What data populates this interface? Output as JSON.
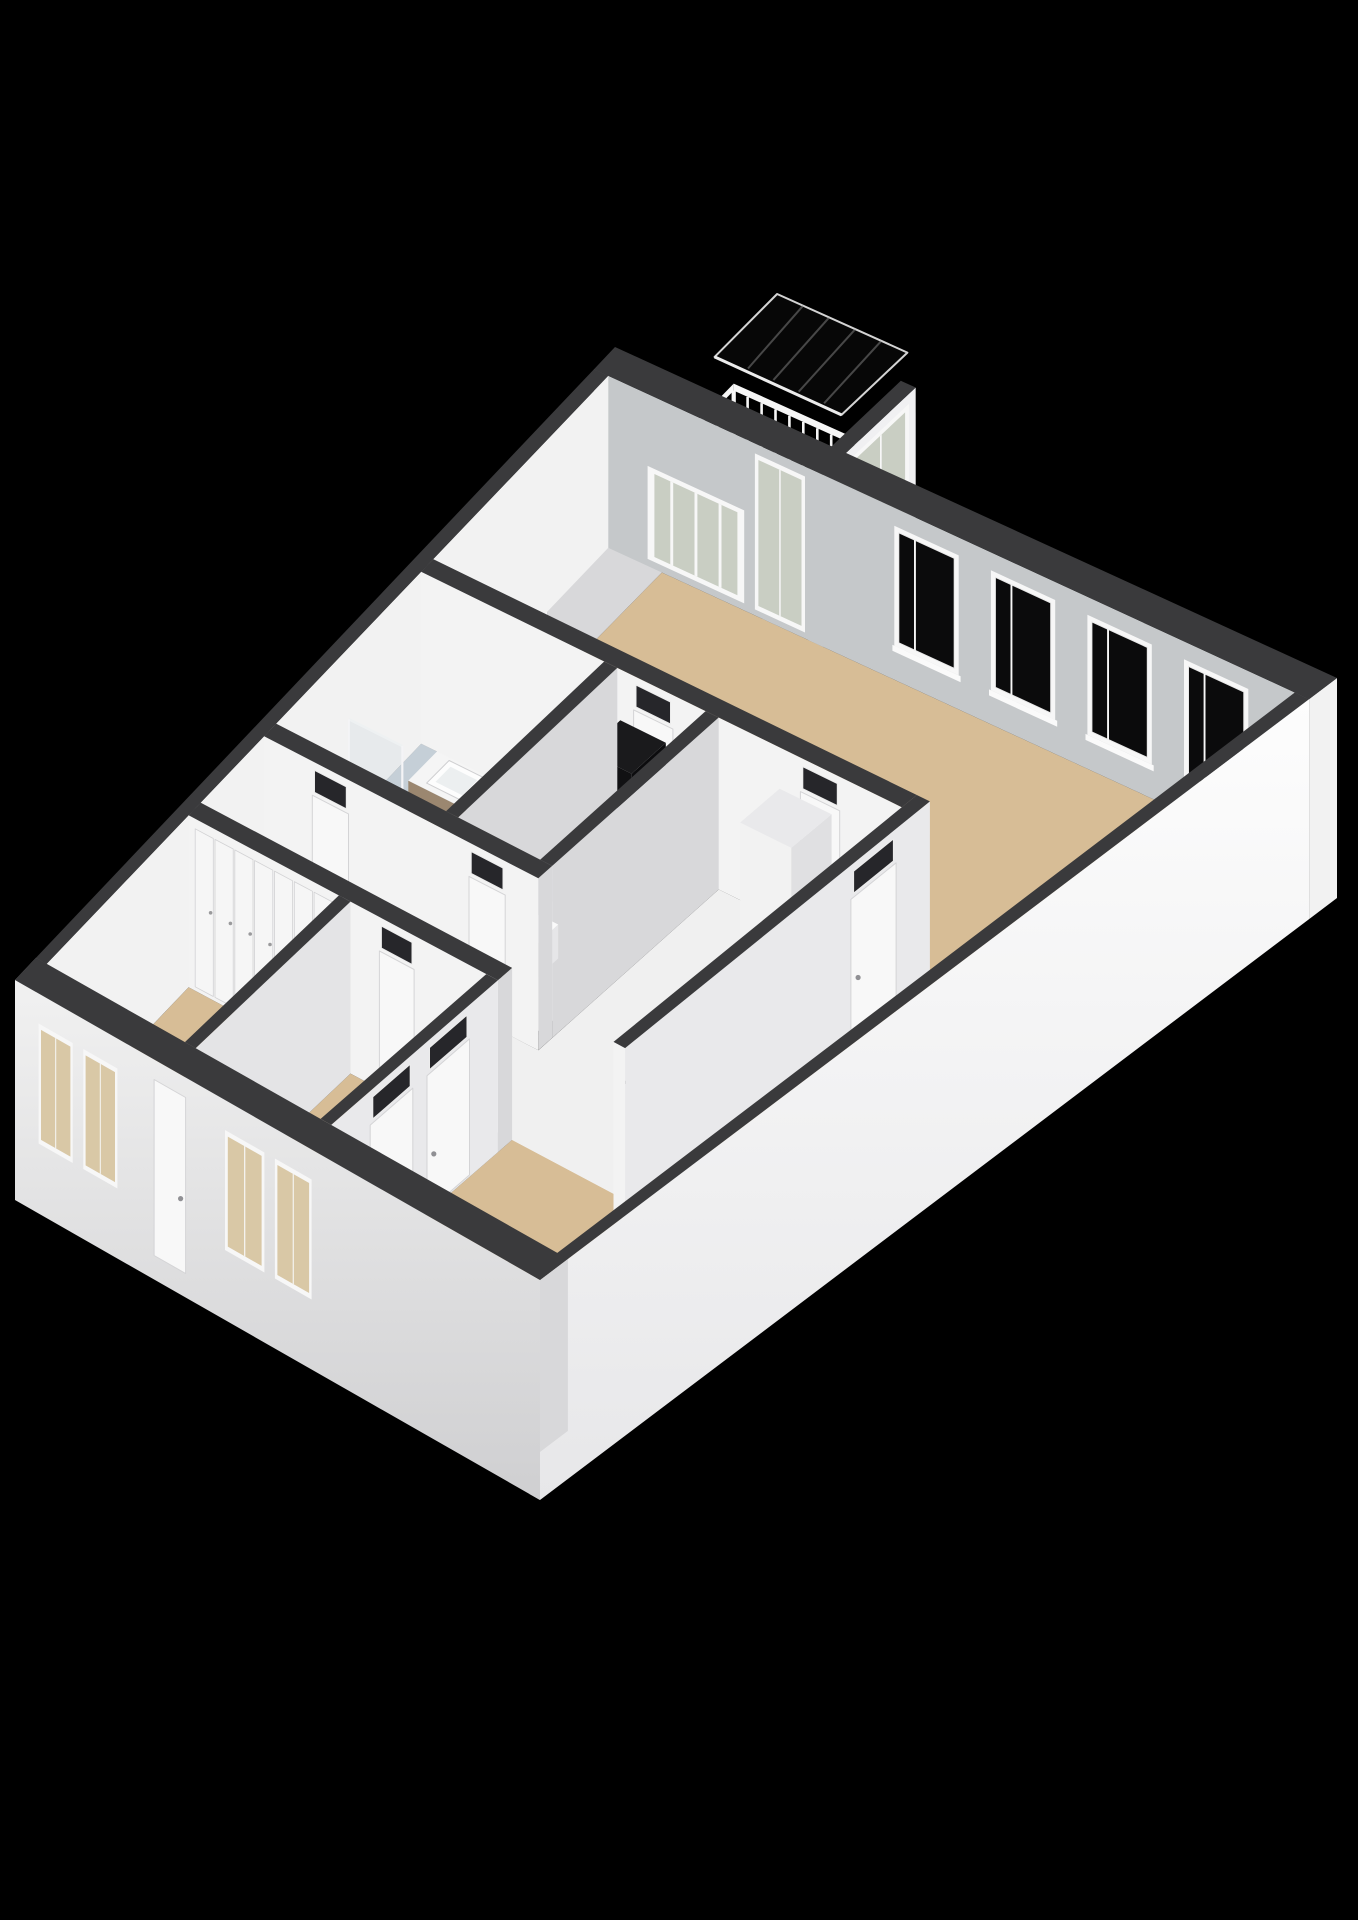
{
  "scene": {
    "width": 1358,
    "height": 1920,
    "background": "#000000",
    "description": "3D isometric floor plan of an apartment on black background"
  },
  "projection": {
    "A": [
      615,
      347
    ],
    "B": [
      1337,
      678
    ],
    "D": [
      15,
      980
    ],
    "C": [
      540,
      1280
    ],
    "wall_height": 172,
    "exterior_drop": 220,
    "rail_top": 78,
    "rail_thickness": 7
  },
  "palette": {
    "wallTop": "#3a3a3c",
    "faceS": "#f3f3f3",
    "faceE": "#d8d8da",
    "neInner": "#c5c8ca",
    "extCapW": "#98989a",
    "floorWood": "#d7bd96",
    "floorWhite": "#f0f0f0",
    "floorBath": "#b7c3cd",
    "floorShower": "#ced6db",
    "floorBalcony": "#c6c6ba",
    "glassDark": "#0b0b0c",
    "glassPale": "#c9cec3",
    "glassWarm": "#d9c8a6",
    "frame": "#f7f7f7",
    "frameStroke": "#d4d4d6",
    "counterTop": "#232323",
    "cabinet": "#ededed",
    "cabinetSide": "#dcdcde",
    "steel": "#c6cbce",
    "steelDark": "#73797c",
    "burnerOuter": "#c3251d",
    "burnerInner": "#3a0f0c",
    "burnerDot": "#d2342a",
    "wood": "#9b8770",
    "woodSide": "#84715a",
    "nicheTop": "#1a1a1c",
    "nicheS": "#111113",
    "nicheE": "#0c0c0e",
    "red": "#d22b22",
    "transom": "#26262a",
    "handle": "#909094",
    "railWhite": "#f6f6f6",
    "glassShower": "rgba(216,224,228,0.42)",
    "glassShowerEdge": "#eef1f2",
    "canopyFill": "rgba(8,8,8,0.85)",
    "canopyEdge": "#d4d4d4",
    "canopyStreak": "rgba(150,150,150,0.45)"
  },
  "floors": [
    {
      "name": "balcony-floor",
      "rect": [
        0.075,
        -0.105,
        0.3,
        0.0
      ],
      "color": "floorBalcony"
    },
    {
      "name": "living-room-floor",
      "poly": [
        [
          0.095,
          0.035
        ],
        [
          0.98,
          0.035
        ],
        [
          0.98,
          0.965
        ],
        [
          0.555,
          0.965
        ],
        [
          0.555,
          0.325
        ],
        [
          0.095,
          0.325
        ]
      ],
      "color": "floorWood"
    },
    {
      "name": "storage-room-floor",
      "rect": [
        0.02,
        0.035,
        0.075,
        0.325
      ],
      "color": "floorWhite"
    },
    {
      "name": "bathroom-floor",
      "rect": [
        0.02,
        0.345,
        0.3,
        0.585
      ],
      "color": "floorBath"
    },
    {
      "name": "shower-floor",
      "rect": [
        0.03,
        0.375,
        0.115,
        0.475
      ],
      "color": "floorShower"
    },
    {
      "name": "utility-room-floor",
      "rect": [
        0.32,
        0.345,
        0.455,
        0.585
      ],
      "color": "floorWhite"
    },
    {
      "name": "kitchen-floor",
      "rect": [
        0.475,
        0.345,
        0.755,
        0.71
      ],
      "color": "floorWhite"
    },
    {
      "name": "hallway-floor",
      "rect": [
        0.02,
        0.605,
        0.755,
        0.71
      ],
      "color": "floorWhite"
    },
    {
      "name": "bedroom-left-floor",
      "rect": [
        0.02,
        0.73,
        0.28,
        0.965
      ],
      "color": "floorWood"
    },
    {
      "name": "bedroom-bottom-floor",
      "rect": [
        0.3,
        0.73,
        0.535,
        0.965
      ],
      "color": "floorWood"
    }
  ],
  "railings": [
    {
      "name": "balcony-railing-back",
      "from": [
        0.075,
        -0.105
      ],
      "to": [
        0.3,
        -0.105
      ],
      "posts": 13
    },
    {
      "name": "balcony-railing-side",
      "from": [
        0.075,
        0.0
      ],
      "to": [
        0.075,
        -0.105
      ],
      "posts": 5
    }
  ],
  "walls": [
    {
      "name": "ne-exterior-wall",
      "rect": [
        0.0,
        0.0,
        1.0,
        0.035
      ],
      "faces": {
        "s": "neInner",
        "e": "#f2f2f2",
        "eDrop": 220
      },
      "panels": [
        {
          "name": "balcony-picture-window",
          "face": "s",
          "a": 0.075,
          "b": 0.21,
          "kind": "winpale",
          "t": [
            72,
            165
          ],
          "mullions": [
            0.25,
            0.5,
            0.75
          ]
        },
        {
          "name": "balcony-glazed-door",
          "face": "s",
          "a": 0.225,
          "b": 0.295,
          "kind": "winpale",
          "t": [
            10,
            166
          ],
          "mullions": [
            0.5
          ]
        },
        {
          "name": "living-window-1",
          "face": "s",
          "a": 0.42,
          "b": 0.51,
          "kind": "dark",
          "t": [
            18,
            138
          ],
          "sill": true,
          "mullions": [
            0.32
          ]
        },
        {
          "name": "living-window-2",
          "face": "s",
          "a": 0.555,
          "b": 0.645,
          "kind": "dark",
          "t": [
            18,
            138
          ],
          "sill": true,
          "mullions": [
            0.32
          ]
        },
        {
          "name": "living-window-3",
          "face": "s",
          "a": 0.69,
          "b": 0.78,
          "kind": "dark",
          "t": [
            18,
            138
          ],
          "sill": true,
          "mullions": [
            0.32
          ]
        },
        {
          "name": "living-window-4",
          "face": "s",
          "a": 0.825,
          "b": 0.915,
          "kind": "dark",
          "t": [
            18,
            138
          ],
          "sill": true,
          "mullions": [
            0.32
          ]
        }
      ]
    },
    {
      "name": "balcony-side-wall",
      "rect": [
        0.3,
        -0.105,
        0.32,
        0.035
      ],
      "faces": {
        "e": "#f0f0f2"
      },
      "panels": [
        {
          "name": "balcony-side-glazed-door",
          "face": "e",
          "a": -0.095,
          "b": -0.01,
          "kind": "winpale",
          "t": [
            10,
            166
          ],
          "mullions": [
            0.5
          ]
        }
      ]
    },
    {
      "name": "se-exterior-wall",
      "rect": [
        0.98,
        0.035,
        1.0,
        1.0
      ],
      "faces": {
        "e": "gradSE",
        "eDrop": 220,
        "s": "#ededed",
        "sDrop": 220
      }
    },
    {
      "name": "nw-exterior-wall",
      "rect": [
        0.0,
        0.035,
        0.02,
        0.965
      ],
      "faces": {
        "e": "#f2f2f2"
      }
    },
    {
      "name": "storage-wall",
      "rect": [
        0.075,
        0.035,
        0.095,
        0.325
      ],
      "panels": [
        {
          "name": "storage-door",
          "face": "e",
          "a": 0.22,
          "b": 0.29,
          "kind": "door",
          "t": [
            34,
            170
          ],
          "transom": false
        }
      ]
    },
    {
      "name": "living-block-wall",
      "rect": [
        0.02,
        0.325,
        0.755,
        0.345
      ],
      "panels": [
        {
          "name": "corridor-door",
          "face": "s",
          "a": 0.345,
          "b": 0.405,
          "kind": "door",
          "t": [
            34,
            170
          ],
          "transom": true
        },
        {
          "name": "kitchen-top-door",
          "face": "s",
          "a": 0.6,
          "b": 0.66,
          "kind": "door",
          "t": [
            34,
            170
          ],
          "transom": true
        }
      ]
    },
    {
      "name": "bathroom-right-wall",
      "rect": [
        0.3,
        0.345,
        0.32,
        0.585
      ]
    },
    {
      "name": "utility-right-wall",
      "rect": [
        0.455,
        0.345,
        0.475,
        0.585
      ]
    },
    {
      "name": "hall-top-wall",
      "rect": [
        0.02,
        0.585,
        0.475,
        0.605
      ],
      "panels": [
        {
          "name": "bathroom-door",
          "face": "s",
          "a": 0.1,
          "b": 0.16,
          "kind": "door",
          "t": [
            34,
            170
          ],
          "transom": true
        },
        {
          "name": "utility-door",
          "face": "s",
          "a": 0.36,
          "b": 0.42,
          "kind": "door",
          "t": [
            34,
            170
          ],
          "transom": true
        }
      ]
    },
    {
      "name": "kitchen-right-wall",
      "rect": [
        0.755,
        0.325,
        0.775,
        0.73
      ],
      "faces": {
        "e": "#e9e9eb"
      },
      "panels": [
        {
          "name": "kitchen-living-door",
          "face": "e",
          "a": 0.37,
          "b": 0.43,
          "kind": "door",
          "t": [
            34,
            170
          ],
          "transom": true
        }
      ]
    },
    {
      "name": "bedrooms-top-wall",
      "rect": [
        0.02,
        0.71,
        0.555,
        0.73
      ],
      "panels": [
        {
          "name": "closet-row",
          "face": "s",
          "a": 0.03,
          "b": 0.27,
          "kind": "closets",
          "count": 7,
          "t": [
            10,
            168
          ]
        },
        {
          "name": "bedroom-bottom-door",
          "face": "s",
          "a": 0.35,
          "b": 0.41,
          "kind": "door",
          "t": [
            34,
            170
          ],
          "transom": true
        }
      ]
    },
    {
      "name": "bedroom-bottom-right-wall",
      "rect": [
        0.535,
        0.73,
        0.555,
        0.965
      ],
      "faces": {
        "e": "#e9e9eb"
      },
      "panels": [
        {
          "name": "living-hall-door-1",
          "face": "e",
          "a": 0.77,
          "b": 0.83,
          "kind": "door",
          "t": [
            34,
            170
          ],
          "transom": true
        },
        {
          "name": "living-hall-door-2",
          "face": "e",
          "a": 0.85,
          "b": 0.91,
          "kind": "door",
          "t": [
            34,
            170
          ],
          "transom": true
        }
      ]
    },
    {
      "name": "bedroom-divider-wall",
      "rect": [
        0.28,
        0.73,
        0.3,
        0.965
      ],
      "faces": {
        "e": "#e4e4e6"
      }
    },
    {
      "name": "sw-exterior-wall",
      "rect": [
        0.0,
        0.965,
        1.0,
        1.0
      ],
      "faces": {
        "s": "gradSW",
        "sDrop": 220,
        "w": "extCapW",
        "wDrop": 220
      },
      "panels": [
        {
          "name": "bedroom-left-window-1",
          "face": "s",
          "a": 0.045,
          "b": 0.11,
          "kind": "warm",
          "t": [
            30,
            150
          ],
          "mullions": [
            0.5
          ]
        },
        {
          "name": "bedroom-left-window-2",
          "face": "s",
          "a": 0.13,
          "b": 0.195,
          "kind": "warm",
          "t": [
            30,
            150
          ],
          "mullions": [
            0.5
          ]
        },
        {
          "name": "entrance-door",
          "face": "s",
          "a": 0.265,
          "b": 0.325,
          "kind": "door",
          "t": [
            20,
            196
          ],
          "transom": false
        },
        {
          "name": "bedroom-bottom-window-1",
          "face": "s",
          "a": 0.4,
          "b": 0.475,
          "kind": "warm",
          "t": [
            30,
            150
          ],
          "mullions": [
            0.5
          ]
        },
        {
          "name": "bedroom-bottom-window-2",
          "face": "s",
          "a": 0.495,
          "b": 0.565,
          "kind": "warm",
          "t": [
            30,
            150
          ],
          "mullions": [
            0.5
          ]
        }
      ]
    }
  ],
  "boxes": [
    {
      "name": "kitchen-counter",
      "rect": [
        0.67,
        0.43,
        0.75,
        0.65
      ],
      "h": 56,
      "top": "counterTop",
      "s": "cabinet",
      "e": "cabinetSide",
      "burners": [
        [
          0.695,
          0.475
        ],
        [
          0.73,
          0.475
        ],
        [
          0.695,
          0.527
        ],
        [
          0.73,
          0.527
        ]
      ],
      "sink": [
        0.682,
        0.578,
        0.74,
        0.632
      ]
    },
    {
      "name": "kitchen-tall-cabinet",
      "rect": [
        0.59,
        0.365,
        0.67,
        0.42
      ],
      "h": 150,
      "top": "#e9e9eb",
      "s": "#f2f2f2",
      "e": "#e0e0e2"
    },
    {
      "name": "bathroom-vanity",
      "rect": [
        0.1,
        0.4,
        0.27,
        0.45
      ],
      "h": 55,
      "top": "#f5f5f5",
      "s": "wood",
      "e": "woodSide",
      "basins": [
        [
          0.122,
          0.407,
          0.18,
          0.443
        ],
        [
          0.196,
          0.407,
          0.252,
          0.443
        ]
      ]
    },
    {
      "name": "utility-niche",
      "rect": [
        0.345,
        0.365,
        0.415,
        0.415
      ],
      "h": 140,
      "top": "nicheTop",
      "s": "nicheS",
      "e": "nicheE",
      "reds": [
        [
          0.382,
          0.415,
          52
        ],
        [
          0.382,
          0.415,
          82
        ]
      ]
    },
    {
      "name": "toilet",
      "rect": [
        0.345,
        0.5,
        0.39,
        0.55
      ],
      "h": 34,
      "top": "#fafafa",
      "s": "#f1f1f3",
      "e": "#e6e6e8"
    }
  ],
  "glass_walls": [
    {
      "name": "shower-glass-side",
      "from": [
        0.115,
        0.375
      ],
      "to": [
        0.115,
        0.475
      ],
      "top": 62
    },
    {
      "name": "shower-glass-front",
      "from": [
        0.03,
        0.475
      ],
      "to": [
        0.115,
        0.475
      ],
      "top": 62
    }
  ],
  "canopy": {
    "name": "balcony-glass-canopy",
    "poly": [
      [
        0.125,
        -0.115
      ],
      [
        0.3,
        -0.115
      ],
      [
        0.3,
        -0.015
      ],
      [
        0.125,
        -0.015
      ]
    ],
    "rise": 22,
    "streaks": 4
  }
}
